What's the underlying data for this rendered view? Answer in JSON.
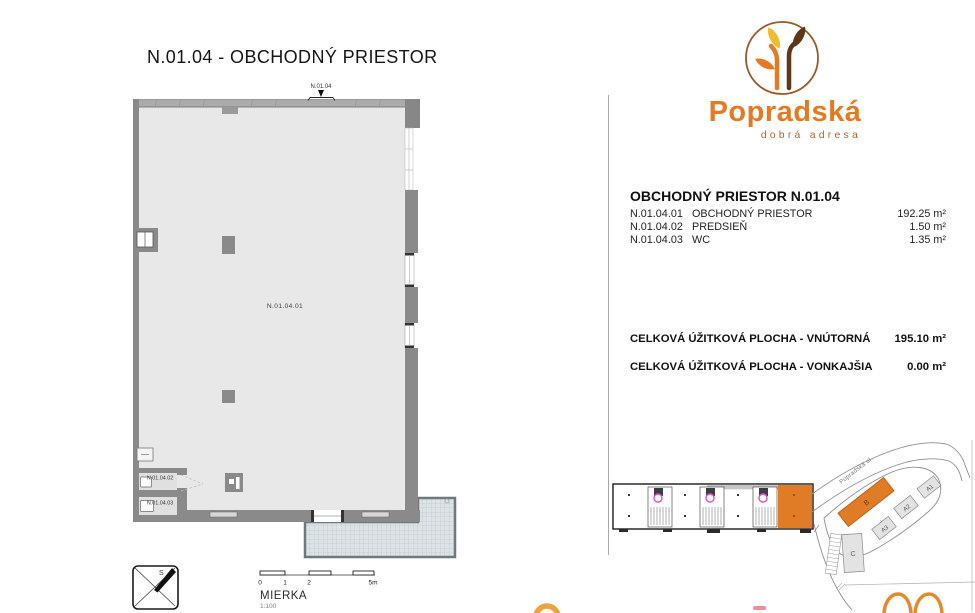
{
  "page": {
    "title": "N.01.04 - OBCHODNÝ PRIESTOR"
  },
  "plan": {
    "entrance_label": "N.01.04",
    "labels": {
      "main_room": "N.01.04.01",
      "predsien": "N.01.04.02",
      "wc": "N.01.04.03"
    }
  },
  "compass": {
    "north": "S"
  },
  "scale": {
    "label": "MIERKA",
    "ratio": "1:100",
    "ticks": [
      "0",
      "1",
      "2",
      "5m"
    ]
  },
  "logo": {
    "name": "Popradská",
    "tagline": "dobrá adresa"
  },
  "unit": {
    "header": "OBCHODNÝ PRIESTOR N.01.04",
    "rooms": [
      {
        "code": "N.01.04.01",
        "name": "OBCHODNÝ PRIESTOR",
        "area": "192.25 m²"
      },
      {
        "code": "N.01.04.02",
        "name": "PREDSIEŇ",
        "area": "1.50 m²"
      },
      {
        "code": "N.01.04.03",
        "name": "WC",
        "area": "1.35 m²"
      }
    ],
    "totals": [
      {
        "label": "CELKOVÁ ÚŽITKOVÁ PLOCHA - VNÚTORNÁ",
        "value": "195.10 m²"
      },
      {
        "label": "CELKOVÁ ÚŽITKOVÁ PLOCHA - VONKAJŠIA",
        "value": "0.00 m²"
      }
    ]
  },
  "sitemap": {
    "street": "Popradská ul.",
    "buildings": {
      "b": "B",
      "a1": "A1",
      "a2": "A2",
      "a3": "A3",
      "c": "C"
    }
  },
  "colors": {
    "accent_orange": "#E07B26",
    "logo_yellow": "#EFBE2E",
    "logo_brown": "#5E3719",
    "stair_magenta": "#E04FC8"
  }
}
